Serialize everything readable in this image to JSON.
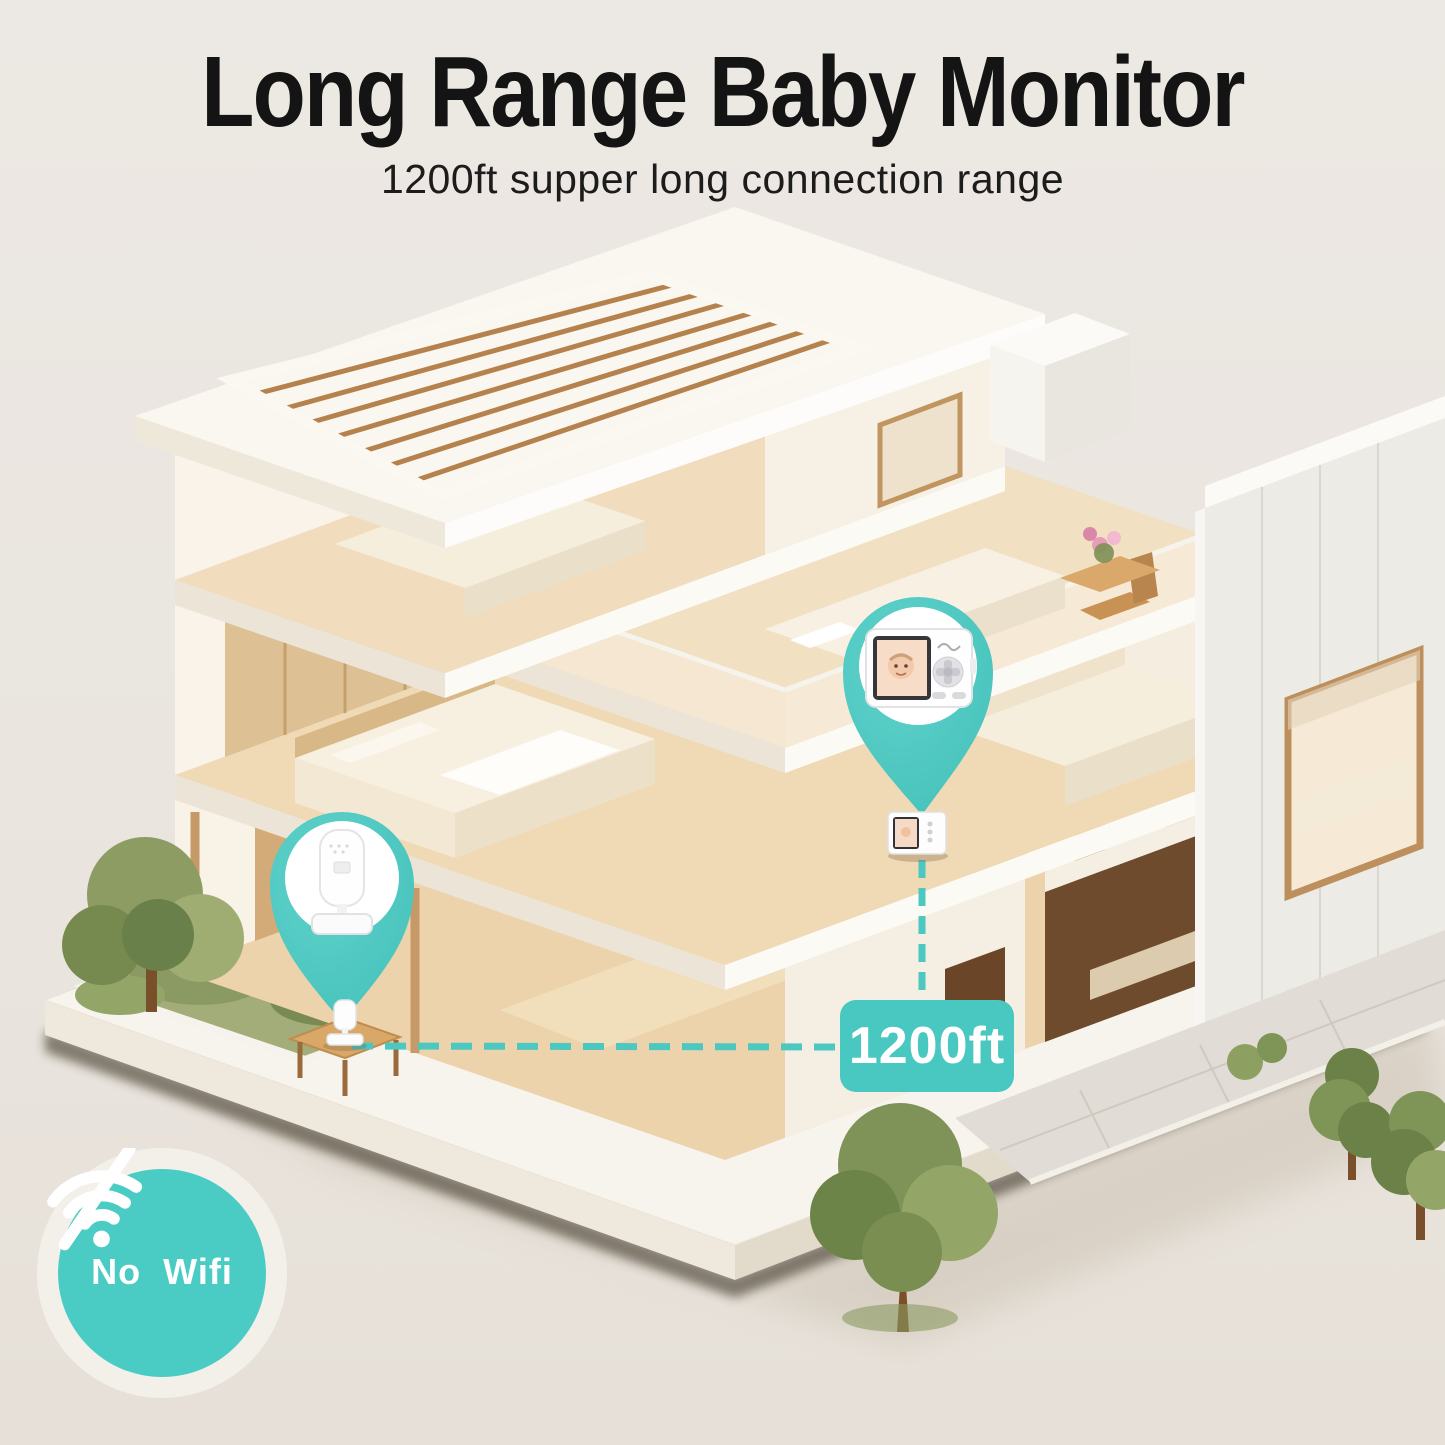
{
  "header": {
    "title": "Long Range Baby Monitor",
    "subtitle": "1200ft supper long connection range"
  },
  "annotations": {
    "range_badge_label": "1200ft",
    "no_wifi_label": "No  Wifi",
    "accent_color": "#4cc8c2",
    "connection_line": "dashed-range-line",
    "camera_pin_icon": "location-pin-icon",
    "monitor_pin_icon": "location-pin-icon",
    "no_wifi_icon": "wifi-off-icon",
    "camera_device": "baby-camera",
    "monitor_device": "baby-monitor-handheld"
  },
  "colors": {
    "background": "#ece8e3",
    "title_text": "#141414",
    "badge_text": "#ffffff"
  },
  "scene": {
    "type": "isometric-cutaway-house-render"
  }
}
